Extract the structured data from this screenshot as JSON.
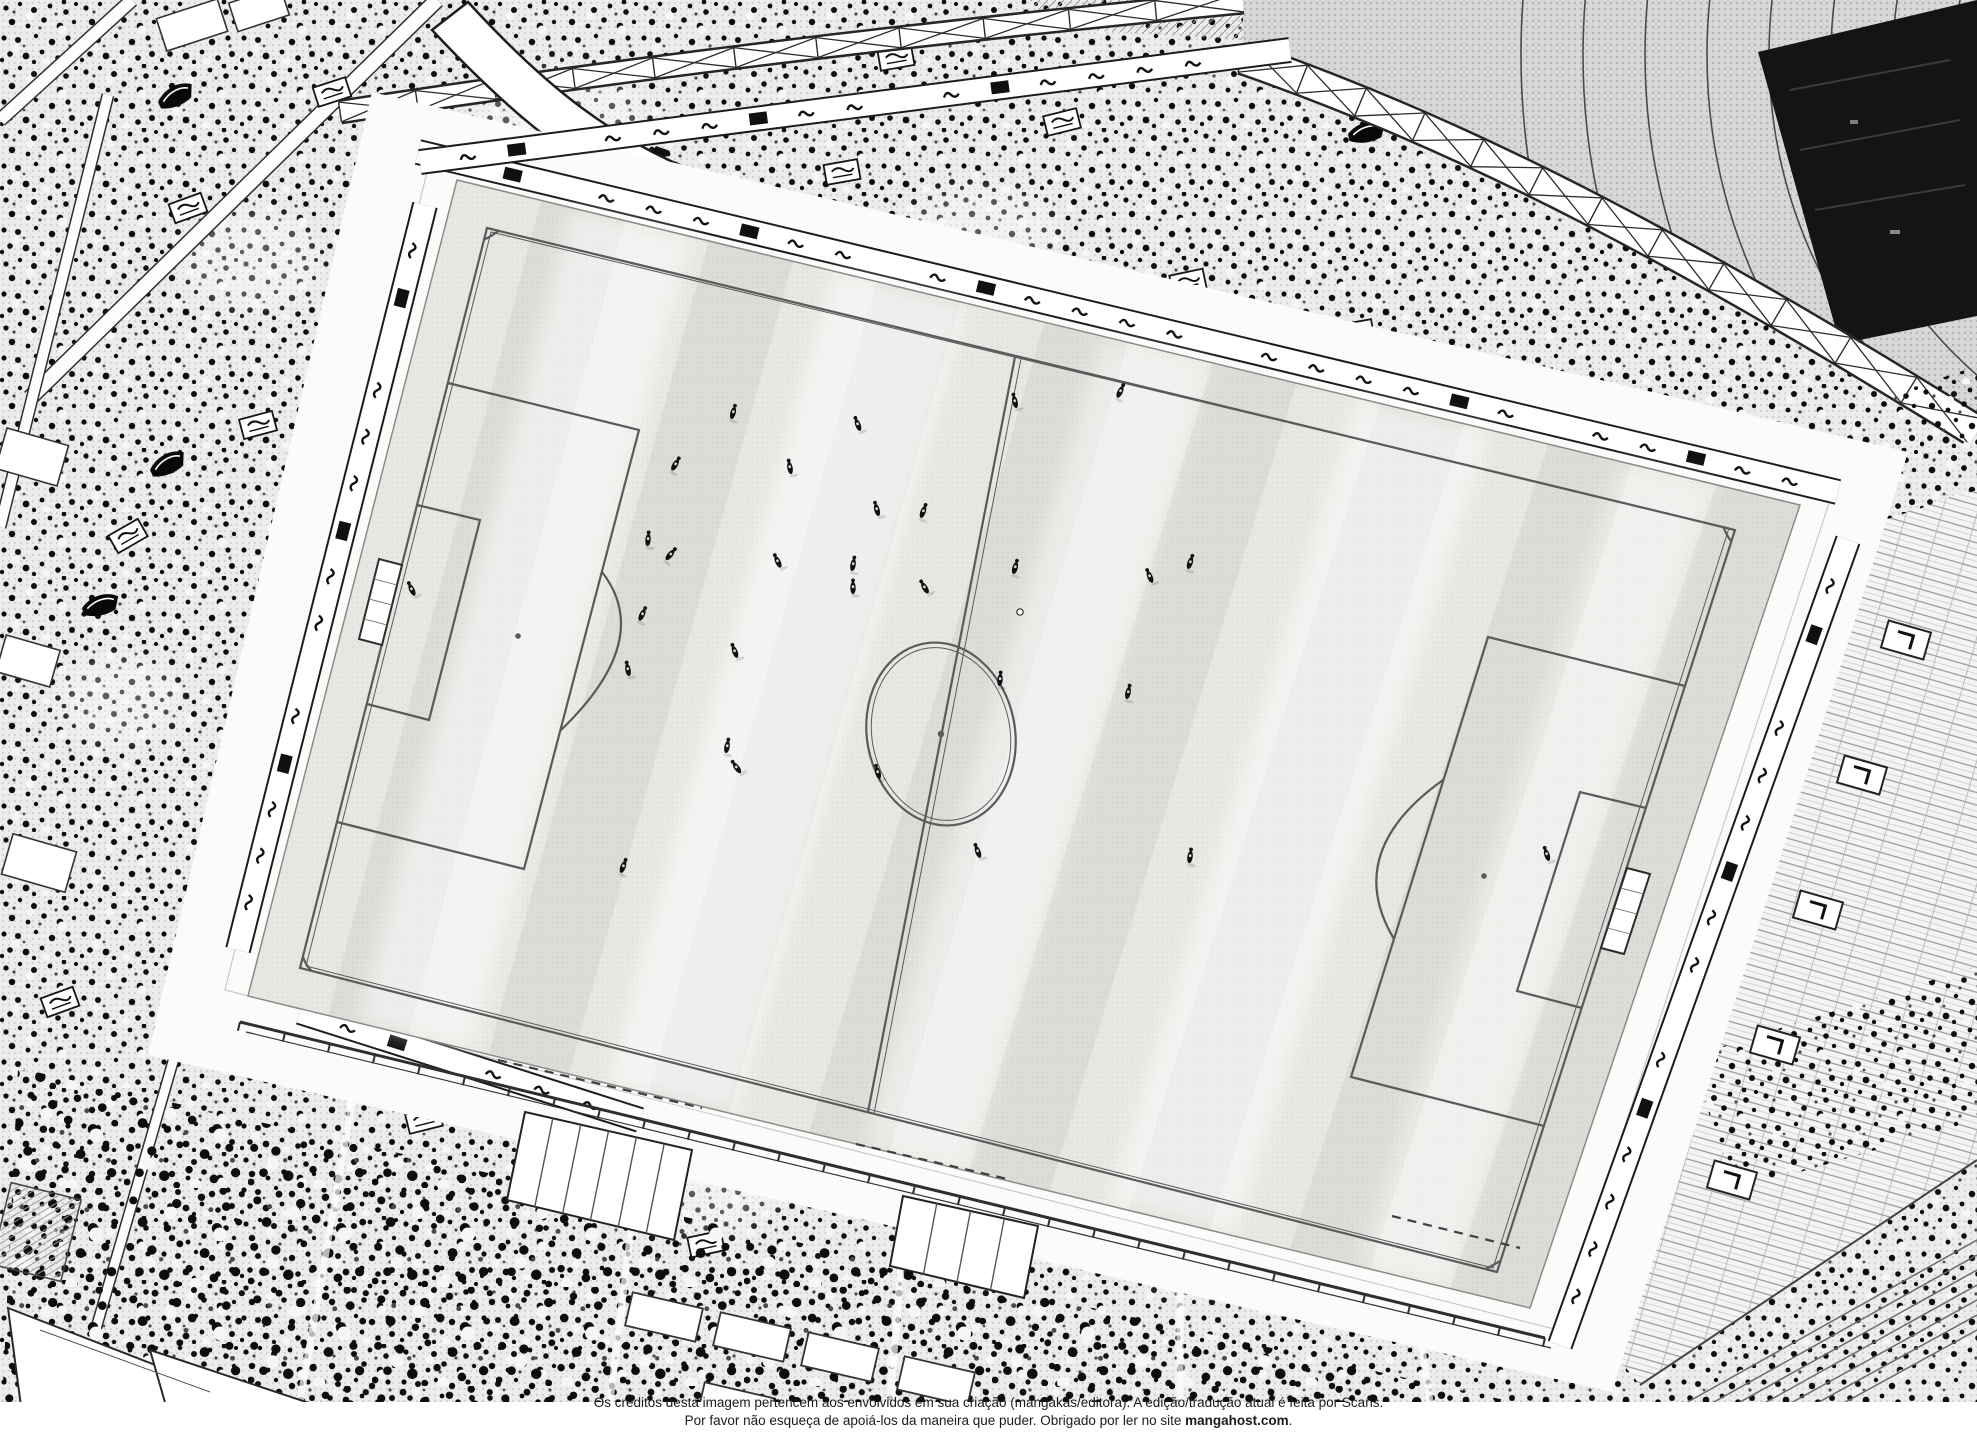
{
  "page": {
    "credits_line1": "Os créditos desta imagem pertencem aos envolvidos em sua criação (mangakás/editora). A edição/tradução atual é feita por Scans.",
    "credits_line2_prefix": "Por favor não esqueça de apoiá-los da maneira que puder. Obrigado por ler no site ",
    "credits_site": "mangahost.com",
    "credits_line2_suffix": "."
  },
  "scene": {
    "description": "aerial-manga-view-of-football-stadium-during-match",
    "colors": {
      "paper": "#ffffff",
      "ink": "#101010",
      "crowd_bg": "#edecea",
      "grass": "#e7e6e2",
      "roof_gray": "#d8d7d5",
      "dark_zone": "#141414",
      "line_gray": "#5a5a5a",
      "seat_bg": "#f5f4f2",
      "walkway": "#fbfbfa"
    },
    "grass_corners": {
      "tl": [
        457,
        180
      ],
      "tr": [
        1800,
        505
      ],
      "br": [
        1530,
        1308
      ],
      "bl": [
        248,
        996
      ]
    },
    "stripe_count": 16,
    "streaks": [
      [
        0.13,
        0.045,
        0.5
      ],
      [
        0.33,
        0.05,
        0.55
      ],
      [
        0.52,
        0.04,
        0.45
      ],
      [
        0.72,
        0.05,
        0.5
      ],
      [
        0.9,
        0.035,
        0.4
      ]
    ],
    "players": [
      [
        733,
        413,
        15
      ],
      [
        858,
        425,
        -20
      ],
      [
        675,
        465,
        30
      ],
      [
        790,
        468,
        -10
      ],
      [
        648,
        540,
        5
      ],
      [
        670,
        555,
        40
      ],
      [
        778,
        562,
        -25
      ],
      [
        853,
        565,
        10
      ],
      [
        877,
        510,
        -15
      ],
      [
        923,
        512,
        20
      ],
      [
        853,
        588,
        0
      ],
      [
        925,
        588,
        -30
      ],
      [
        1015,
        568,
        15
      ],
      [
        628,
        670,
        -10
      ],
      [
        642,
        615,
        25
      ],
      [
        735,
        652,
        -20
      ],
      [
        727,
        747,
        10
      ],
      [
        737,
        768,
        -35
      ],
      [
        623,
        867,
        20
      ],
      [
        878,
        773,
        -15
      ],
      [
        1000,
        680,
        5
      ],
      [
        978,
        852,
        -20
      ],
      [
        1120,
        392,
        25
      ],
      [
        1015,
        402,
        -12
      ],
      [
        1190,
        563,
        18
      ],
      [
        1150,
        577,
        -22
      ],
      [
        1128,
        693,
        12
      ],
      [
        1547,
        855,
        -18
      ],
      [
        1190,
        857,
        8
      ],
      [
        412,
        590,
        -25
      ]
    ],
    "ball": [
      1020,
      612
    ],
    "banners": [
      [
        188,
        208,
        -20
      ],
      [
        258,
        425,
        -15
      ],
      [
        128,
        536,
        -30
      ],
      [
        332,
        92,
        -18
      ],
      [
        618,
        142,
        -12
      ],
      [
        842,
        172,
        -10
      ],
      [
        1062,
        122,
        -14
      ],
      [
        1188,
        282,
        -12
      ],
      [
        1356,
        332,
        -10
      ],
      [
        1538,
        382,
        -14
      ],
      [
        1676,
        452,
        -12
      ],
      [
        236,
        962,
        -16
      ],
      [
        424,
        1120,
        -14
      ],
      [
        706,
        1244,
        -12
      ],
      [
        934,
        1230,
        -10
      ],
      [
        1242,
        1122,
        -12
      ],
      [
        1448,
        1078,
        -10
      ],
      [
        60,
        1002,
        -20
      ],
      [
        896,
        58,
        -10
      ],
      [
        1760,
        1120,
        -14
      ]
    ],
    "dark_flags": [
      [
        158,
        102,
        -25
      ],
      [
        82,
        608,
        -15
      ],
      [
        296,
        768,
        -30
      ],
      [
        1348,
        134,
        -12
      ],
      [
        150,
        470,
        -25
      ],
      [
        520,
        330,
        -20
      ]
    ],
    "light_patches": [
      [
        560,
        120,
        85,
        55
      ],
      [
        250,
        260,
        70,
        50
      ],
      [
        980,
        230,
        75,
        45
      ],
      [
        1430,
        420,
        65,
        40
      ],
      [
        120,
        700,
        60,
        45
      ],
      [
        700,
        1180,
        90,
        55
      ],
      [
        1200,
        1250,
        75,
        45
      ],
      [
        380,
        980,
        55,
        40
      ],
      [
        1700,
        1230,
        60,
        40
      ],
      [
        900,
        330,
        50,
        35
      ]
    ],
    "aisles": [
      [
        437,
        0,
        30,
        398,
        14
      ],
      [
        132,
        0,
        0,
        120,
        12
      ],
      [
        108,
        95,
        0,
        527,
        10
      ],
      [
        185,
        1020,
        95,
        1332,
        9
      ]
    ],
    "bottom_aisles": [
      [
        355,
        1085,
        300,
        1402
      ],
      [
        640,
        1155,
        610,
        1402
      ],
      [
        905,
        1220,
        890,
        1402
      ],
      [
        1180,
        1280,
        1180,
        1402
      ],
      [
        1420,
        1335,
        1430,
        1402
      ]
    ],
    "ads_bands": [
      [
        418,
        152,
        1838,
        492
      ],
      [
        425,
        205,
        238,
        950
      ],
      [
        1848,
        540,
        1560,
        1345
      ],
      [
        300,
        1012,
        640,
        1120
      ],
      [
        420,
        162,
        1290,
        50
      ]
    ],
    "trusses": [
      {
        "kind": "q",
        "p": [
          [
            340,
            112
          ],
          [
            760,
            48
          ],
          [
            1243,
            2
          ]
        ],
        "w": 20,
        "n": 11
      },
      {
        "kind": "c",
        "p": [
          [
            1243,
            58
          ],
          [
            1480,
            140
          ],
          [
            1700,
            260
          ],
          [
            1977,
            432
          ]
        ],
        "w": 30,
        "n": 12
      }
    ],
    "seat_entrances": [
      [
        1906,
        640
      ],
      [
        1862,
        775
      ],
      [
        1818,
        910
      ],
      [
        1775,
        1045
      ],
      [
        1732,
        1180
      ]
    ],
    "roof_arcs": {
      "cx": 2255,
      "cy": 55,
      "r0": 300,
      "step": 62,
      "n": 8
    },
    "fence": [
      240,
      1022,
      1545,
      1338
    ],
    "br_lines": 7
  }
}
